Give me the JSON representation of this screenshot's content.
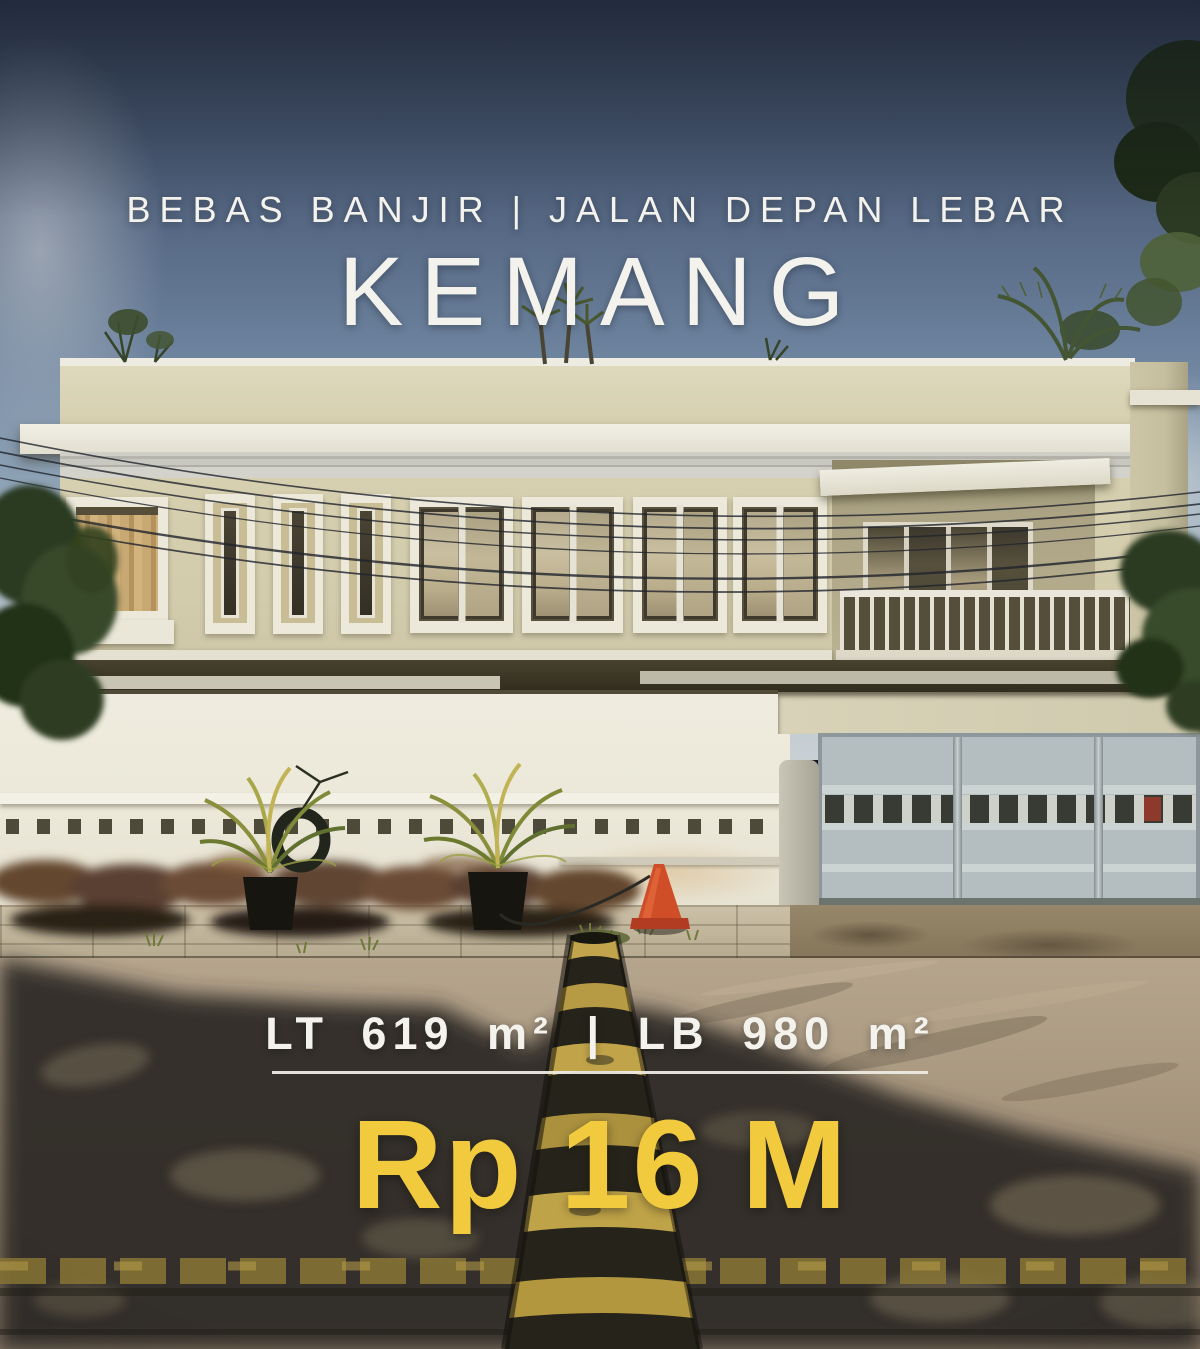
{
  "poster": {
    "tagline": "BEBAS BANJIR | JALAN DEPAN LEBAR",
    "location": "KEMANG",
    "specs": "LT 619 m² | LB 980 m²",
    "price": "Rp 16 M",
    "colors": {
      "overlay_text": "#f3f2ed",
      "price_text": "#f2ca3e",
      "divider": "#eceae2",
      "sky_top": "#3c4a62",
      "house_cream": "#d6cfb0",
      "gate_gray": "#b4bdbf",
      "speed_bump_yellow": "#c2a44c"
    }
  }
}
